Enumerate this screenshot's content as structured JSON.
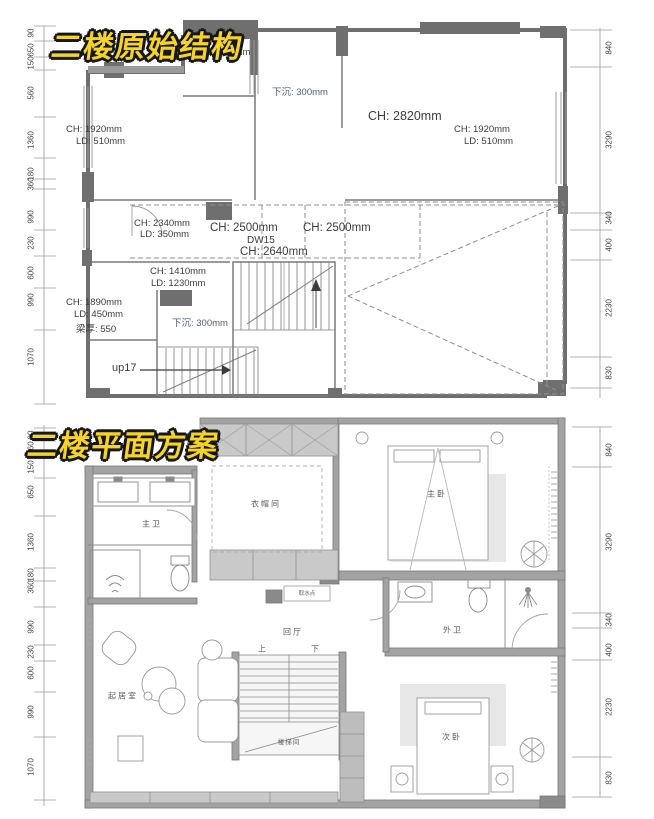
{
  "sheet": {
    "background": "#ffffff",
    "title_color": "#f5d327",
    "title_outline": "#161616",
    "wall_dark": "#6f6f6f",
    "wall_gray": "#a3a3a3",
    "sunken_text_color": "#4d6375"
  },
  "plans": [
    {
      "title": "二楼原始结构",
      "dims_left": [
        "90",
        "650",
        "150",
        "560",
        "1360",
        "180",
        "360",
        "990",
        "230",
        "600",
        "990",
        "1070"
      ],
      "dims_right": [
        "840",
        "3290",
        "340",
        "400",
        "2230",
        "830"
      ],
      "labels": {
        "partial_ch": "90mm",
        "partial_ld": "LD: 1020mm",
        "sunken_top": "下沉: 300mm",
        "ch_2820": "CH: 2820mm",
        "left_ch_1920": "CH: 1920mm",
        "left_ld_510": "LD: 510mm",
        "right_ch_1920": "CH: 1920mm",
        "right_ld_510": "LD: 510mm",
        "ch_2340": "CH: 2340mm",
        "ld_350": "LD: 350mm",
        "ch_2500_a": "CH: 2500mm",
        "ch_2500_b": "CH: 2500mm",
        "dw15": "DW15",
        "ch_2640": "CH: 2640mm",
        "ch_1410": "CH: 1410mm",
        "ld_1230": "LD: 1230mm",
        "ch_1890": "CH: 1890mm",
        "ld_450": "LD: 450mm",
        "beam_550": "梁厚: 550",
        "sunken_left": "下沉: 300mm",
        "up17": "up17"
      }
    },
    {
      "title": "二楼平面方案",
      "dims_left": [
        "90",
        "560",
        "150",
        "650",
        "1360",
        "180",
        "360",
        "990",
        "230",
        "600",
        "990",
        "1070"
      ],
      "dims_right": [
        "840",
        "3290",
        "340",
        "400",
        "2230",
        "830"
      ],
      "rooms": {
        "master_bath": "主卫",
        "cloakroom": "衣帽间",
        "master_bedroom": "主卧",
        "hall": "回厅",
        "guest_bath": "外卫",
        "water_point": "取水点",
        "stair_up": "上",
        "stair_down": "下",
        "living_room": "起居室",
        "stairwell": "楼梯间",
        "second_bedroom": "次卧"
      }
    }
  ]
}
